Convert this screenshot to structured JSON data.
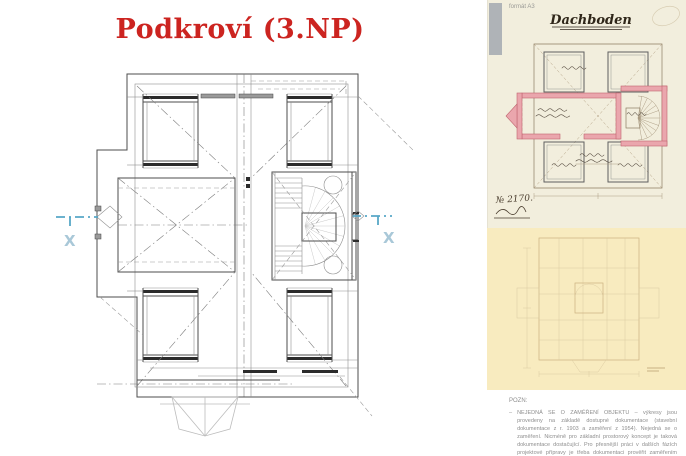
{
  "window": {
    "width": 686,
    "height": 456
  },
  "left_panel": {
    "title": "Podkroví (3.NP)",
    "title_color": "#cc2420",
    "section_markers": {
      "label": "X",
      "line_color": "#57a7c7",
      "label_color": "#a9c8d8"
    }
  },
  "right_panel": {
    "format_label": "formát A3",
    "historic_sheet": {
      "title": "Dachboden",
      "plan_number": "№ 2170.",
      "paper_color": "#f2eedd",
      "wall_color": "#eaa6ad"
    },
    "faded_sheet": {
      "paper_color": "#f8ebbf"
    },
    "note": {
      "heading": "POZN:",
      "bullet": "–",
      "text": "NEJEDNÁ SE O ZAMĚŘENÍ OBJEKTU – výkresy jsou provedeny na základě dostupné dokumentace (stavební dokumentace z r. 1903 a zaměření z 1954). Nejedná se o zaměření. Nicméně pro základní prostorový koncept je taková dokumentace dostačující. Pro přesnější práci v dalších fázích projektové přípravy je třeba dokumentaci prověřit zaměřením objektu na místě."
    }
  }
}
